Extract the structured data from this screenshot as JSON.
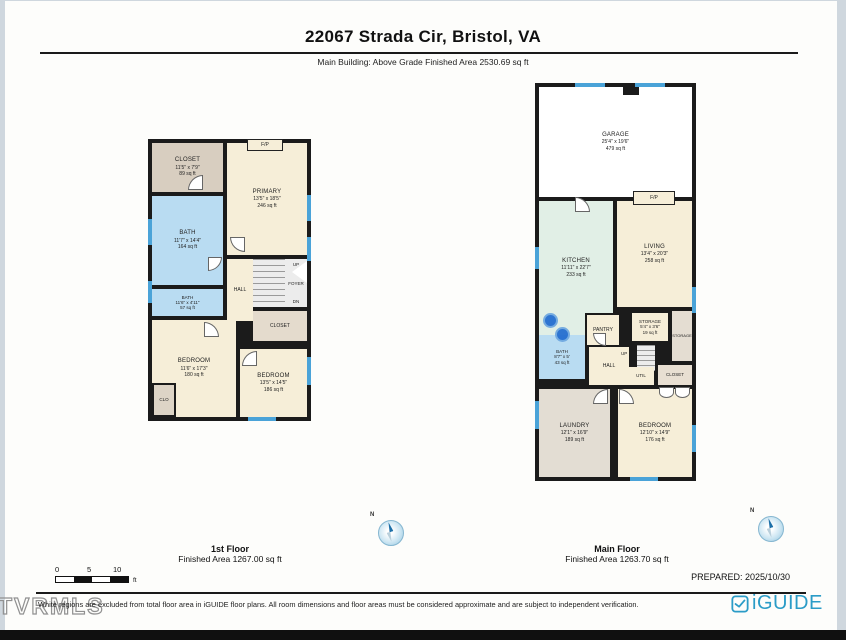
{
  "header": {
    "title": "22067 Strada Cir, Bristol, VA",
    "subtitle": "Main Building: Above Grade Finished Area 2530.69 sq ft"
  },
  "floor1": {
    "caption_title": "1st Floor",
    "caption_area": "Finished Area 1267.00 sq ft",
    "fp_label": "F/P",
    "closet_top": {
      "name": "CLOSET",
      "dims": "11'5\" x 7'9\"",
      "area": "89 sq ft"
    },
    "primary": {
      "name": "PRIMARY",
      "dims": "13'5\" x 18'5\"",
      "area": "246 sq ft"
    },
    "bath_main": {
      "name": "BATH",
      "dims": "11'7\" x 14'4\"",
      "area": "164 sq ft"
    },
    "bath_small": {
      "name": "BATH",
      "dims": "11'6\" x 4'11\"",
      "area": "57 sq ft"
    },
    "hall": {
      "name": "HALL"
    },
    "stairs": {
      "up": "UP",
      "foyer": "FOYER",
      "dn": "DN"
    },
    "closet_mid": {
      "name": "CLOSET"
    },
    "bedroom_left": {
      "name": "BEDROOM",
      "dims": "11'6\" x 17'3\"",
      "area": "180 sq ft"
    },
    "bedroom_right": {
      "name": "BEDROOM",
      "dims": "13'5\" x 14'5\"",
      "area": "186 sq ft"
    },
    "clo": {
      "name": "CLO"
    }
  },
  "floor2": {
    "caption_title": "Main Floor",
    "caption_area": "Finished Area 1263.70 sq ft",
    "fp_label": "F/P",
    "garage": {
      "name": "GARAGE",
      "dims": "25'4\" x 19'6\"",
      "area": "479 sq ft"
    },
    "kitchen": {
      "name": "KITCHEN",
      "dims": "11'11\" x 22'7\"",
      "area": "233 sq ft"
    },
    "living": {
      "name": "LIVING",
      "dims": "13'4\" x 20'3\"",
      "area": "258 sq ft"
    },
    "pantry": {
      "name": "PANTRY"
    },
    "storage_small": {
      "name": "STORAGE",
      "dims": "5'4\" x 3'6\"",
      "area": "19 sq ft"
    },
    "storage_right": {
      "name": "STORAGE"
    },
    "bath": {
      "name": "BATH",
      "dims": "8'7\" x 5'",
      "area": "43 sq ft"
    },
    "hall": {
      "name": "HALL"
    },
    "stairs": {
      "up": "UP"
    },
    "util": {
      "name": "UTIL"
    },
    "closet": {
      "name": "CLOSET"
    },
    "laundry": {
      "name": "LAUNDRY",
      "dims": "12'1\" x 16'9\"",
      "area": "189 sq ft"
    },
    "bedroom": {
      "name": "BEDROOM",
      "dims": "12'10\" x 14'9\"",
      "area": "176 sq ft"
    }
  },
  "compass": {
    "label": "N"
  },
  "footer": {
    "scale": {
      "tick0": "0",
      "tick1": "5",
      "tick2": "10",
      "unit": "ft"
    },
    "prepared": "PREPARED: 2025/10/30",
    "disclaimer": "White regions are excluded from total floor area in iGUIDE floor plans. All room dimensions and floor areas must be considered approximate and are subject to independent verification.",
    "brand": "iGUIDE",
    "watermark": "TVRMLS"
  },
  "colors": {
    "wall": "#1b1b1b",
    "window_blue": "#4aa3d8",
    "camera_dot_blue": "#1f6bd0",
    "brand_blue": "#2b9cc7",
    "room_cream": "#f6eed8",
    "room_blue": "#b9dcf2",
    "room_tan": "#d8cec0",
    "room_green": "#e1efe6",
    "room_gray": "#e3ddd3"
  }
}
